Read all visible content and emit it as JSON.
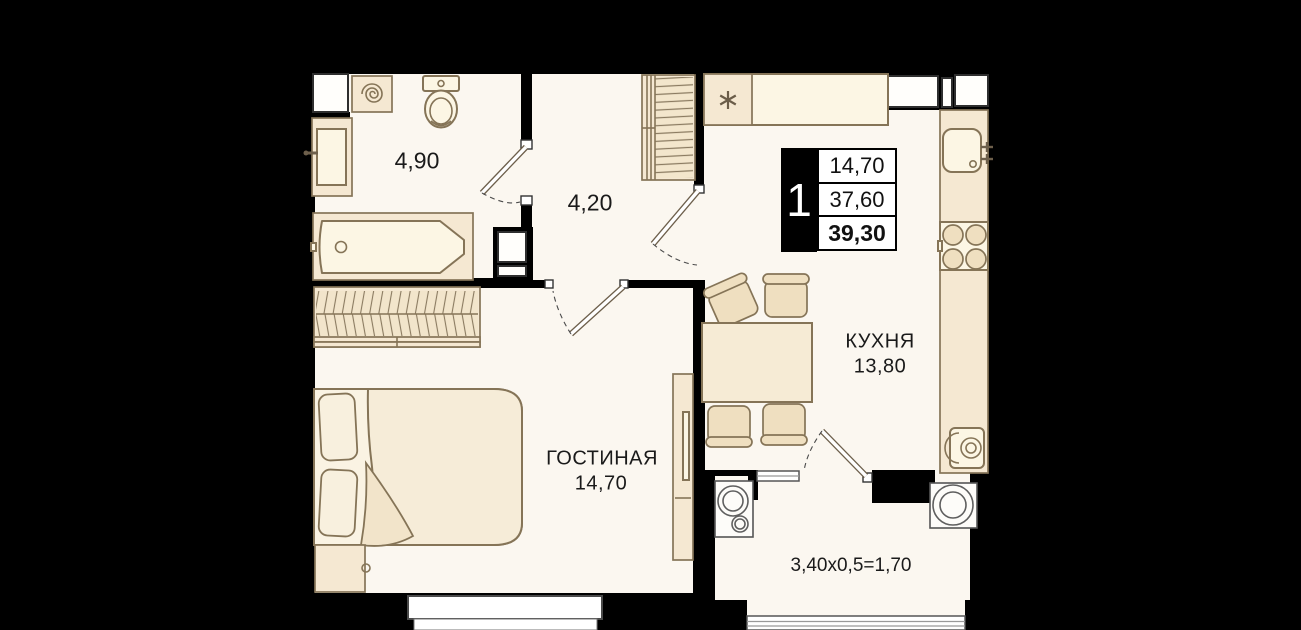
{
  "badge": {
    "rooms_count": "1",
    "living_area": "14,70",
    "apartment_area": "37,60",
    "total_area": "39,30"
  },
  "rooms": {
    "bathroom": {
      "area": "4,90"
    },
    "hallway": {
      "area": "4,20"
    },
    "kitchen": {
      "name": "КУХНЯ",
      "area": "13,80"
    },
    "living": {
      "name": "ГОСТИНАЯ",
      "area": "14,70"
    },
    "balcony": {
      "dimensions": "3,40x0,5=1,70"
    }
  },
  "icons": {
    "washing_machine": "spiral-icon",
    "fridge": "asterisk-icon"
  },
  "colors": {
    "background": "#000000",
    "floor": "#fbf7f0",
    "wall": "#000000",
    "furniture": "#f5e8d2",
    "furniture_dark": "#efdfc0",
    "cream": "#fcf6e4",
    "outline": "#857457",
    "text": "#1a1a1a"
  }
}
